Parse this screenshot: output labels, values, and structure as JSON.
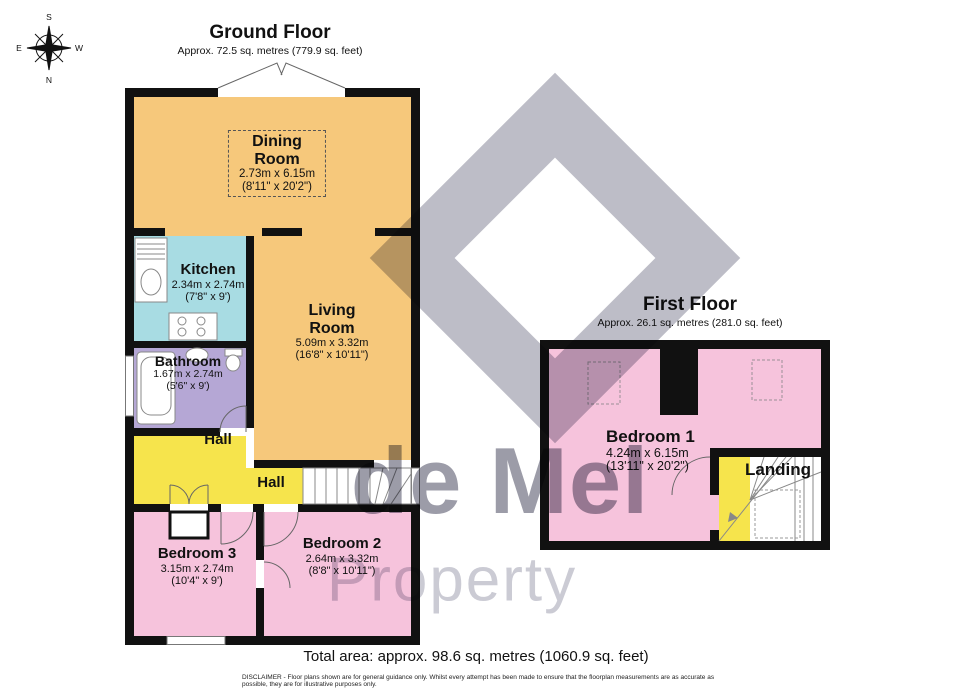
{
  "colors": {
    "wall": "#111111",
    "living_dining": "#F6C87B",
    "kitchen": "#A8DCE3",
    "bathroom": "#B5A7D5",
    "hall": "#F6E44C",
    "bedroom": "#F6C3DC",
    "watermark_shape": "#BDBDC7",
    "watermark_text1": "#9C9CA8",
    "watermark_text2": "#CBCBD4"
  },
  "compass": {
    "n": "N",
    "s": "S",
    "e": "E",
    "w": "W"
  },
  "ground_floor": {
    "title": "Ground Floor",
    "subtitle": "Approx. 72.5 sq. metres (779.9 sq. feet)",
    "rooms": {
      "dining": {
        "name1": "Dining",
        "name2": "Room",
        "metric": "2.73m x 6.15m",
        "imperial": "(8'11\" x 20'2\")"
      },
      "kitchen": {
        "name1": "Kitchen",
        "metric": "2.34m x 2.74m",
        "imperial": "(7'8\" x 9')"
      },
      "living": {
        "name1": "Living",
        "name2": "Room",
        "metric": "5.09m x 3.32m",
        "imperial": "(16'8\" x 10'11\")"
      },
      "bathroom": {
        "name1": "Bathroom",
        "metric": "1.67m x 2.74m",
        "imperial": "(5'6\" x 9')"
      },
      "hall_inner": {
        "name1": "Hall"
      },
      "hall_outer": {
        "name1": "Hall"
      },
      "bedroom3": {
        "name1": "Bedroom 3",
        "metric": "3.15m x 2.74m",
        "imperial": "(10'4\" x 9')"
      },
      "bedroom2": {
        "name1": "Bedroom 2",
        "metric": "2.64m x 3.32m",
        "imperial": "(8'8\" x 10'11\")"
      }
    }
  },
  "first_floor": {
    "title": "First Floor",
    "subtitle": "Approx. 26.1 sq. metres (281.0 sq. feet)",
    "rooms": {
      "bedroom1": {
        "name1": "Bedroom 1",
        "metric": "4.24m x 6.15m",
        "imperial": "(13'11\" x 20'2\")"
      },
      "landing": {
        "name1": "Landing"
      }
    }
  },
  "watermark": {
    "line1": "de Mel",
    "line2": "Property"
  },
  "footer": {
    "total_area": "Total area: approx. 98.6 sq. metres (1060.9 sq. feet)",
    "disclaimer": "DISCLAIMER -  Floor plans shown are for general guidance only. Whilst every attempt has been made to ensure that the floorplan measurements are as accurate as possible, they are for illustrative purposes only."
  }
}
